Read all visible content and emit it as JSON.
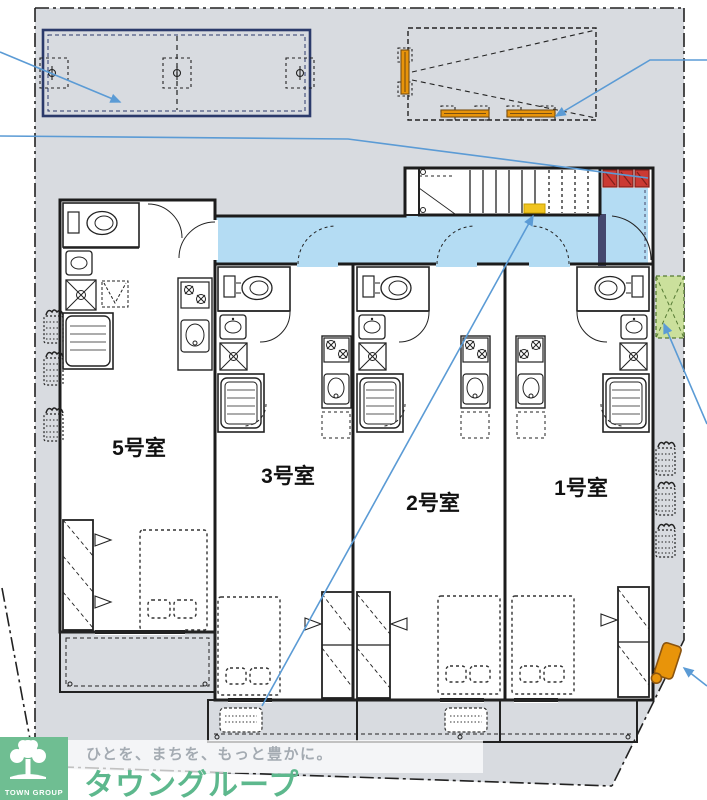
{
  "plan": {
    "room_labels": {
      "room5": "5号室",
      "room3": "3号室",
      "room2": "2号室",
      "room1": "1号室"
    },
    "colors": {
      "site_fill": "#d8dbe0",
      "corridor_fill": "#b4dcf3",
      "stair_highlight": "#f0c420",
      "meter_box_red": "#cb3a33",
      "planting_green": "#cbe09c",
      "equipment_orange": "#e8940a",
      "parking_navy": "#2b3a6b",
      "leader_blue": "#5b9bd5"
    }
  },
  "footer": {
    "logo_text": "TOWN GROUP",
    "tagline": "ひとを、まちを、もっと豊かに。",
    "brand": "タウングループ"
  }
}
